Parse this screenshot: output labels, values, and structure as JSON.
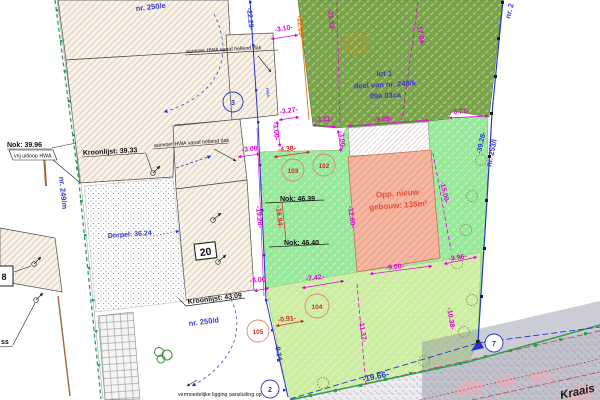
{
  "parcels": {
    "nr_250e": "nr. 250/e",
    "nr_249m": "nr. 249/m",
    "nr_250d": "nr. 250/d",
    "nr_253l": "nr. 253/l",
    "nr_2": "nr. 2",
    "lot1": {
      "line1": "lot 1",
      "line2": "deel van nr. 249/k",
      "line3": "09a 03ca"
    }
  },
  "building": {
    "huisnr_20": "20",
    "huisnr_8": "8",
    "opp_line1": "Opp. nieuw",
    "opp_line2": "gebouw: 135m²"
  },
  "annotations": {
    "nok_39_96": "Nok: 39.96",
    "vrij_uitloop": "vrij uitloop HWA",
    "kroonlijst_39_33": "Kroonlijst: 39.33",
    "aanvoer_hwa_1": "aanvoer HWA vanaf hellend dak",
    "aanvoer_hwa_2": "aanvoer HWA vanaf hellend dak",
    "nok_46_39": "Nok: 46.39",
    "nok_46_40": "Nok: 46.40",
    "kroonlijst_43_09": "Kroonlijst: 43.09",
    "dorpel": "Dorpel: 36.24",
    "vermoedelijk": "vermoedelijke ligging aansluiting op",
    "ss": "ss",
    "hwa": "HWA",
    "street": "Kraais"
  },
  "dimensions": {
    "blue": {
      "d22_29": "-22.29-",
      "d39_28": "-39.28-",
      "d9_34": "-9.34-",
      "d19_66": "-19.66-"
    },
    "magenta": {
      "d3_10": "-3.10-",
      "d21_53": "-21.53-",
      "d17_04": "-17.04-",
      "d3_27": "-3.27-",
      "d3_11": "-3.11-",
      "d9_09": "-9.09-",
      "d6_71": "-6.71-",
      "d3_00a": "-3.00",
      "d3_00b": "-3.00-",
      "d3_00c": "-3.00-",
      "d3_00d": "-3.00",
      "d19_28": "-19.28-",
      "d12_60": "-12.60-",
      "d15_00": "-15.00-",
      "d9_00": "-9.00-",
      "d7_42": "-7.42-",
      "d3_96": "-3.96-",
      "d11_37": "-11.37-",
      "d10_38": "-10.38-"
    },
    "red": {
      "d4_38": "-4.38-",
      "d16_84": "-16.84-",
      "d0_91": "-0.91-"
    },
    "orange": {
      "d22_69": "-22.69-"
    }
  },
  "points": {
    "p102": "102",
    "p103": "103",
    "p104": "104",
    "p105": "105",
    "c2": "2",
    "c3": "3",
    "c7": "7"
  },
  "colors": {
    "magenta": "#e100d8",
    "blue": "#2636c8",
    "red": "#d42a20",
    "orange": "#d96c00",
    "dark_green_parcel": "#7aa351",
    "light_green_parcel": "#98e89b",
    "pale_green_parcel": "#cdeea2",
    "new_building_pink": "#f5b7a1",
    "existing_building": "#f8f2e9",
    "road_gray": "#ececf1"
  }
}
